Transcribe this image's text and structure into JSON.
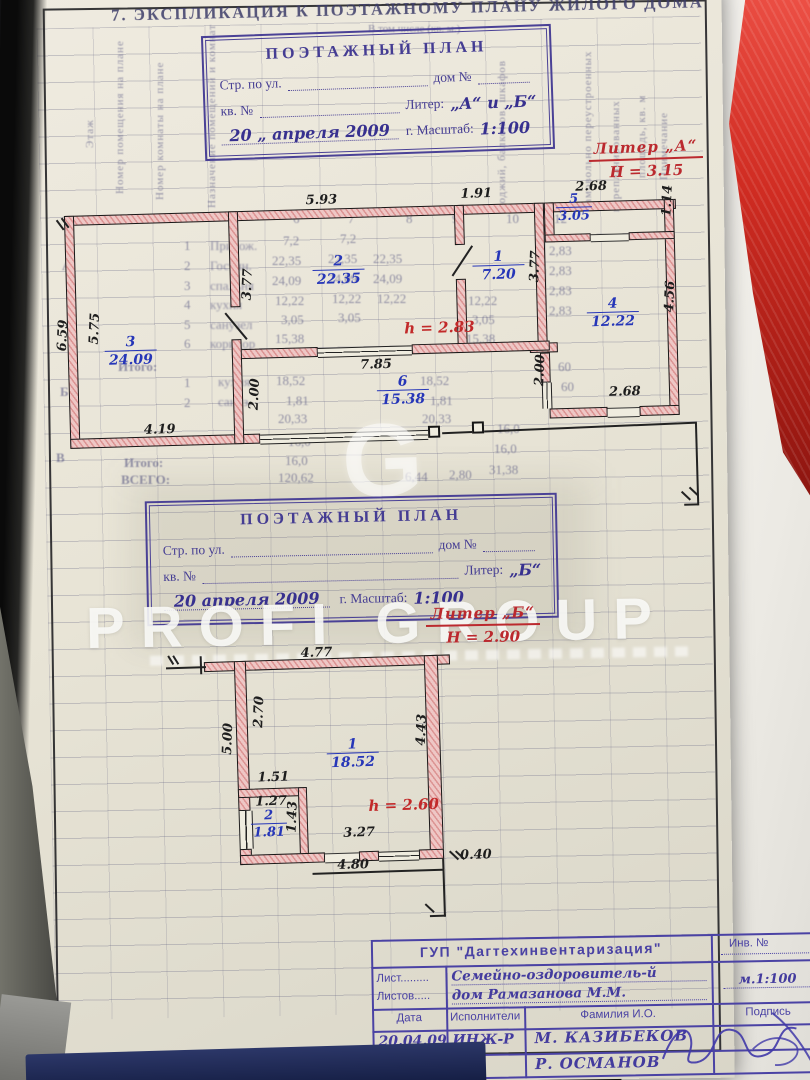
{
  "page_title": "7. ЭКСПЛИКАЦИЯ К ПОЭТАЖНОМУ ПЛАНУ ЖИЛОГО ДОМА",
  "stamp_a": {
    "title": "ПОЭТАЖНЫЙ ПЛАН",
    "street_label": "Стр. по ул.",
    "house_label": "дом №",
    "apt_label": "кв. №",
    "liter_label": "Литер:",
    "liter_value": "„А“ и „Б“",
    "date_value": "20 „ апреля 2009",
    "year_scale_label": "г. Масштаб:",
    "scale_value": "1:100"
  },
  "stamp_b": {
    "title": "ПОЭТАЖНЫЙ ПЛАН",
    "street_label": "Стр. по ул.",
    "house_label": "дом №",
    "apt_label": "кв. №",
    "liter_label": "Литер:",
    "liter_value": "„Б“",
    "date_value": "20 апреля 2009",
    "year_scale_label": "г. Масштаб:",
    "scale_value": "1:100"
  },
  "note_a": {
    "liter": "Литер „А“",
    "height": "H = 3.15"
  },
  "note_b": {
    "liter": "Литер „Б“",
    "height": "H = 2.90"
  },
  "plan_a": {
    "height_note": "h = 2.83",
    "rooms": [
      {
        "num": "1",
        "area": "7.20"
      },
      {
        "num": "2",
        "area": "22.35"
      },
      {
        "num": "3",
        "area": "24.09"
      },
      {
        "num": "4",
        "area": "12.22"
      },
      {
        "num": "5",
        "area": "3.05"
      },
      {
        "num": "6",
        "area": "15.38"
      }
    ],
    "dims": {
      "top_mid": "5.93",
      "top_room1": "1.91",
      "top_room5": "2.68",
      "right_room5": "1.14",
      "room1_wall": "3.77",
      "wall_3_2": "3.77",
      "left_outer": "6.59",
      "left_inner": "5.75",
      "room4_right": "4.56",
      "room4_left": "2.00",
      "mid_wall": "2.00",
      "bottom_mid": "7.85",
      "room4_bottom": "2.68",
      "bottom_left": "4.19"
    }
  },
  "plan_b": {
    "height_note": "h = 2.60",
    "rooms": [
      {
        "num": "1",
        "area": "18.52"
      },
      {
        "num": "2",
        "area": "1.81"
      }
    ],
    "dims": {
      "top": "4.77",
      "left_inner": "2.70",
      "left_outer": "5.00",
      "right": "4.43",
      "shelf": "1.51",
      "closet_top": "1.27",
      "closet_right": "1.43",
      "bottom_inner": "3.27",
      "bottom_outer": "4.80",
      "offset": "0.40"
    }
  },
  "watermark": {
    "glyph": "G",
    "text": "PROFI GROUP"
  },
  "title_block": {
    "org": "ГУП \"Дагтехинвентаризация\"",
    "inv_label": "Инв. №",
    "sheet_label": "Лист.........",
    "sheets_label": "Листов.....",
    "object_line1": "Семейно-оздоровитель-й",
    "object_line2": "дом Рамазанова М.М.",
    "scale_value": "м.1:100",
    "col_date": "Дата",
    "col_executor": "Исполнители",
    "col_name": "Фамилия И.О.",
    "col_sign": "Подпись",
    "date_value": "20.04.09",
    "executor_value": "ИНЖ-Р",
    "name_1": "М. КАЗИБЕКОВ",
    "name_2": "Р. ОСМАНОВ"
  },
  "background_table": {
    "header_center": "В том числе (кв. м.)",
    "col_headers_left": [
      "Этаж",
      "Номер помещения на плане",
      "Номер комнаты на плане",
      "Назначение помещений и комнат"
    ],
    "col_headers_right": [
      "лоджий, балконов, шкафов",
      "самовольно переустроенных",
      "перепланированных",
      "площадь, кв. м",
      "Примечание"
    ],
    "col_numbers": [
      "6",
      "7",
      "8",
      "9",
      "10",
      "12"
    ],
    "row_letters": [
      "А",
      "Б",
      "В"
    ],
    "row_numbers": [
      "1",
      "2",
      "3",
      "4",
      "5",
      "6"
    ],
    "row_numbers2": [
      "1",
      "2"
    ],
    "room_names": [
      "Прихож.",
      "Гостин.",
      "спальня",
      "кухня",
      "санузел",
      "коридор"
    ],
    "room_names2": [
      "кухня",
      "сануз."
    ],
    "values_col1": [
      "7,2",
      "22,35",
      "24,09",
      "12,22",
      "3,05",
      "15,38"
    ],
    "values_col2": [
      "7,2",
      "22,35",
      "24,09",
      "12,22",
      "3,05"
    ],
    "values_col3": [
      "22,35",
      "24,09",
      "12,22"
    ],
    "values_col4": [
      "12,22",
      "3,05",
      "15,38"
    ],
    "sub_rows": [
      "18,52",
      "1,81",
      "20,33"
    ],
    "sub_rows2": [
      "18,52",
      "1,81",
      "20,33"
    ],
    "heights_col": [
      "2,83",
      "2,83",
      "2,83",
      "2,83"
    ],
    "sixty": [
      "60",
      "60"
    ],
    "itogo_label": "Итого:",
    "vsego_label": "ВСЕГО:",
    "total_row1": "16,0",
    "total_row2": "16,0",
    "right_16_1": "16,0",
    "right_16_2": "16,0",
    "right_total": "31,38",
    "vsego_total": "120,62",
    "vsego_v2": "6,44",
    "vsego_v3": "2,80"
  }
}
